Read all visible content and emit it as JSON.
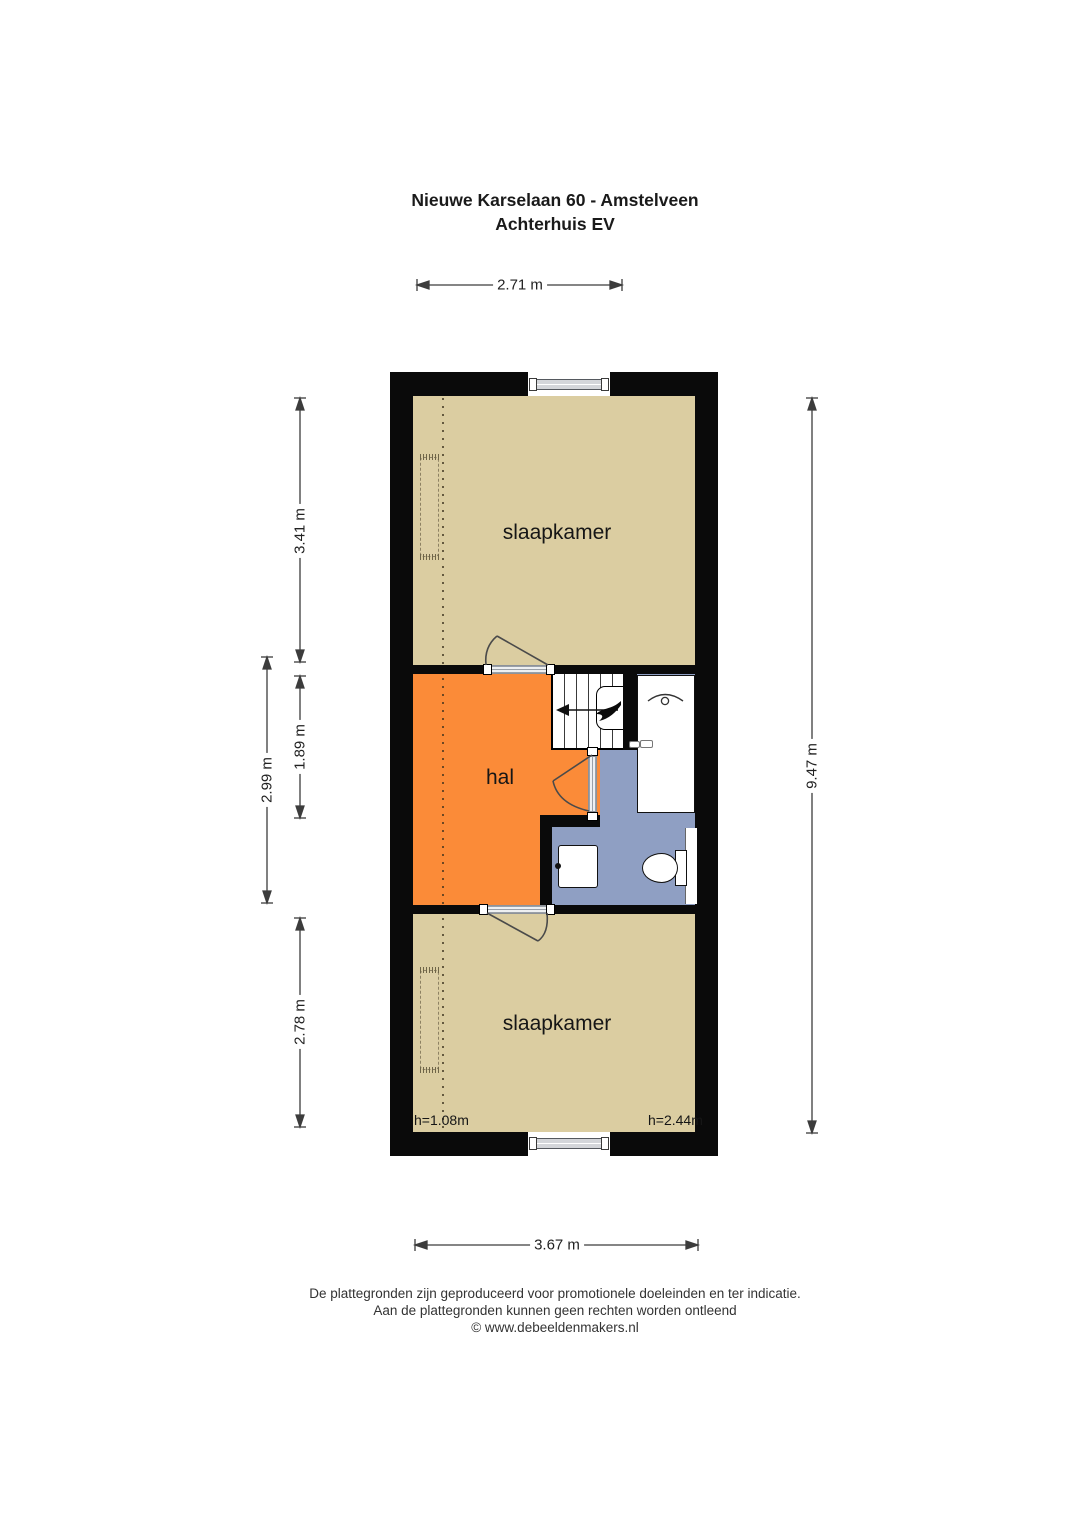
{
  "title": {
    "line1": "Nieuwe Karselaan 60 - Amstelveen",
    "line2": "Achterhuis EV"
  },
  "plan": {
    "rooms": [
      {
        "id": "slaapkamer-top",
        "label": "slaapkamer"
      },
      {
        "id": "hal",
        "label": "hal"
      },
      {
        "id": "slaapkamer-bottom",
        "label": "slaapkamer"
      }
    ],
    "height_notes": [
      {
        "label": "h=1.08m"
      },
      {
        "label": "h=2.44m"
      }
    ],
    "dimensions": {
      "top": "2.71 m",
      "left_top": "3.41 m",
      "left_outer": "2.99 m",
      "left_middle": "1.89 m",
      "left_bottom": "2.78 m",
      "right": "9.47 m",
      "bottom": "3.67 m"
    }
  },
  "footer": {
    "line1": "De plattegronden zijn geproduceerd voor promotionele doeleinden en ter indicatie.",
    "line2": "Aan de plattegronden kunnen geen rechten worden ontleend",
    "line3": "© www.debeeldenmakers.nl"
  },
  "colors": {
    "wall": "#0a0a0a",
    "bedroom_floor": "#dbcda1",
    "hall_floor": "#fb8b38",
    "bathroom_floor": "#8f9fc3",
    "dimension_line": "#3c3c3c"
  }
}
